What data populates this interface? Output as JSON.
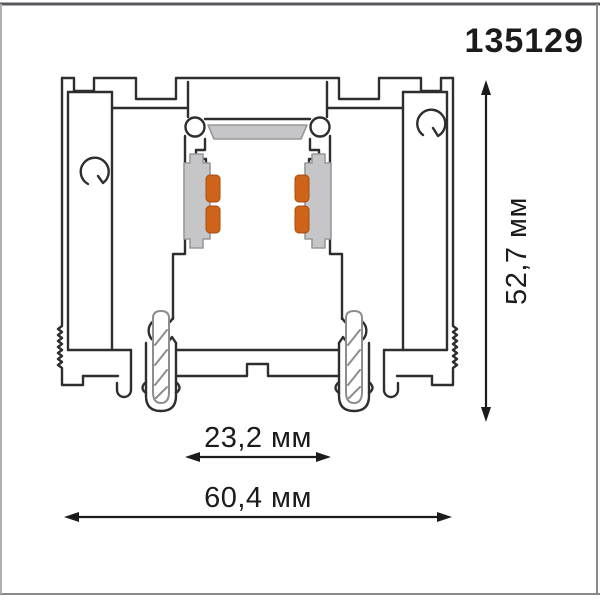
{
  "drawing": {
    "product_code": "135129",
    "dimensions": {
      "height": {
        "label": "52,7 мм",
        "value_mm": 52.7
      },
      "inner_width": {
        "label": "23,2 мм",
        "value_mm": 23.2
      },
      "outer_width": {
        "label": "60,4 мм",
        "value_mm": 60.4
      }
    },
    "colors": {
      "outline": "#2e2e30",
      "insert_gray": "#c6c6c8",
      "contact_orange": "#cf6318",
      "frame_border": "#9a9a9e"
    }
  }
}
